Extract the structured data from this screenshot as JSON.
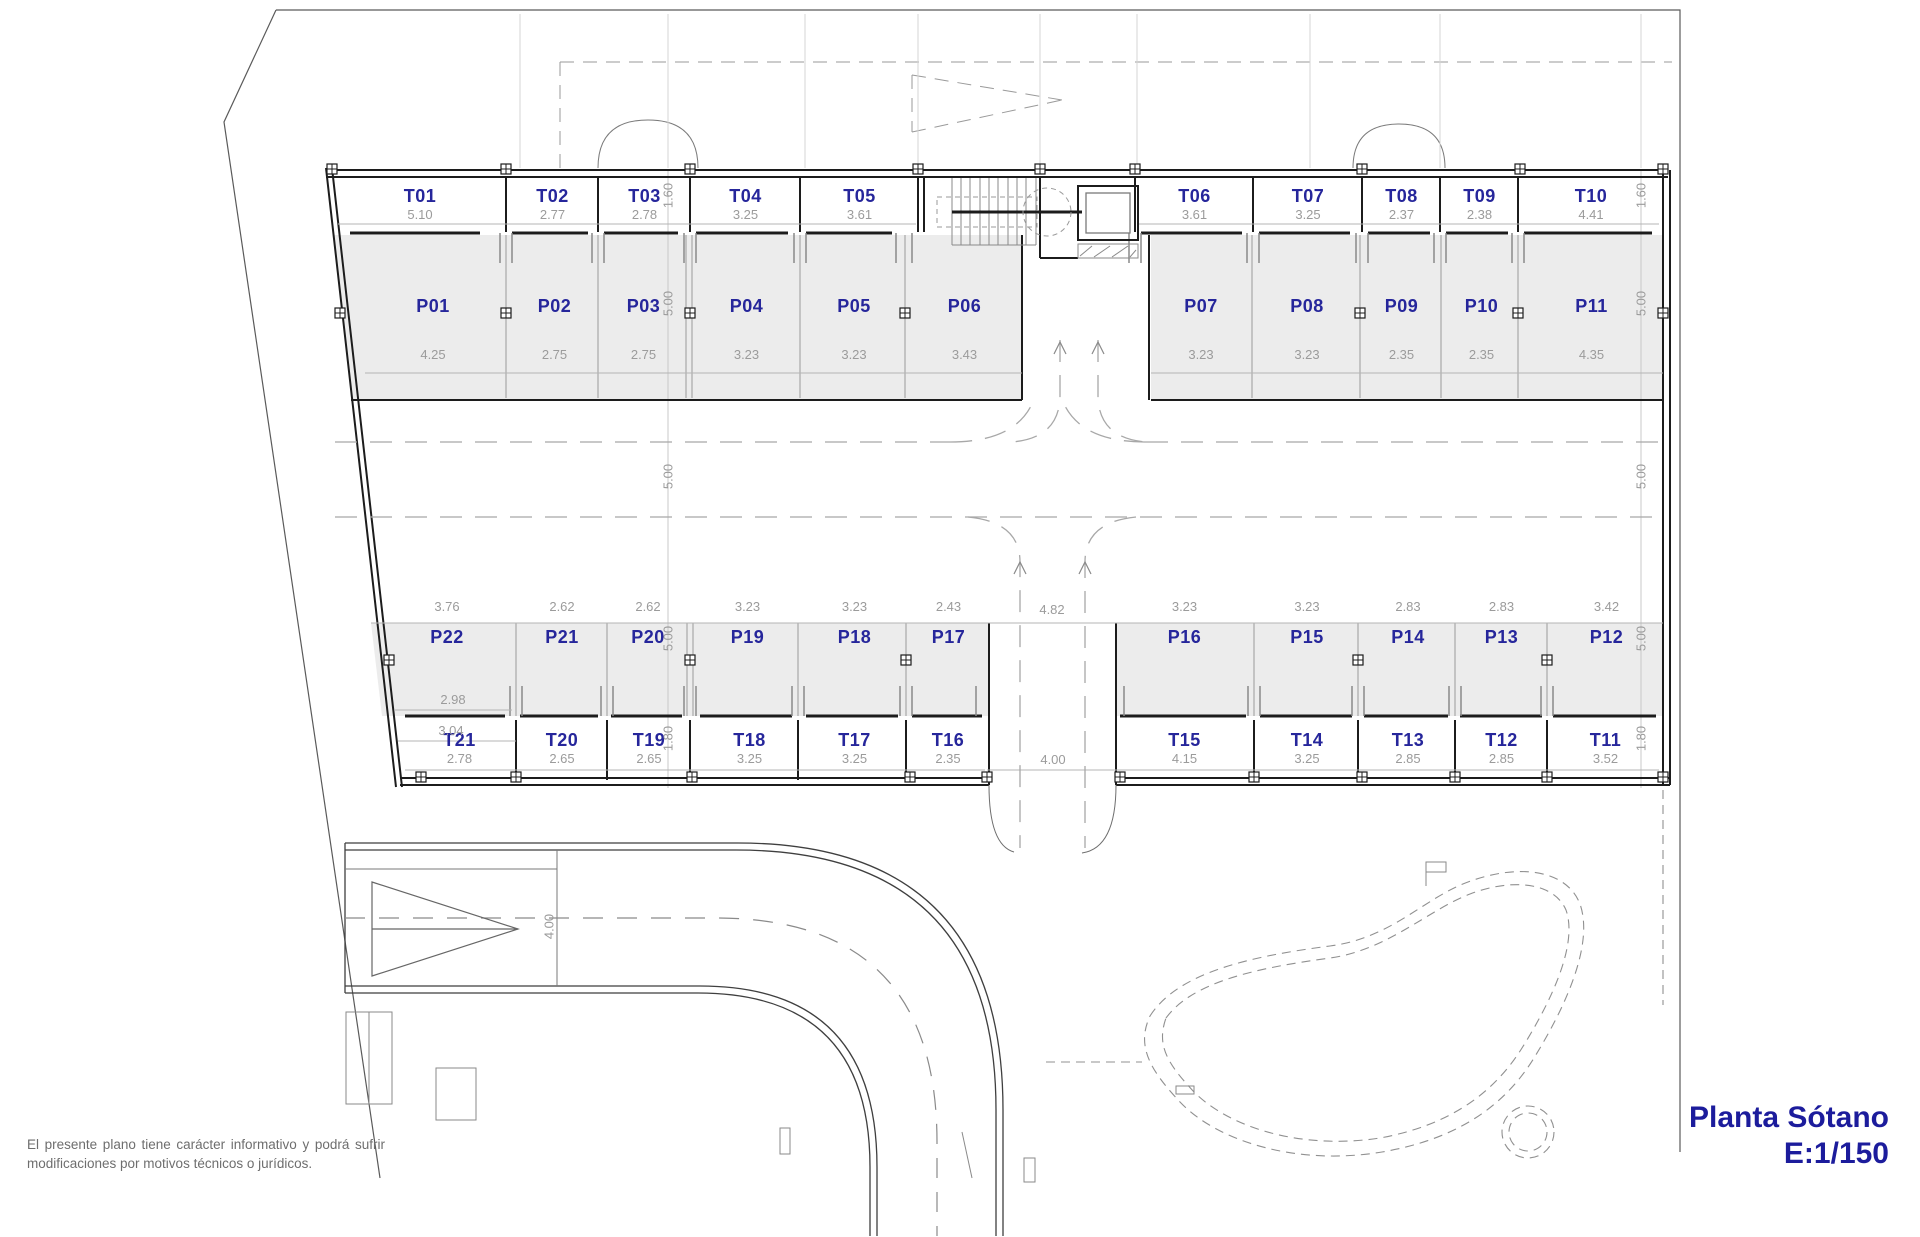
{
  "title": {
    "name": "Planta Sótano",
    "scale": "E:1/150"
  },
  "disclaimer": "El presente plano tiene carácter informativo y podrá sufrir modificaciones por motivos técnicos o jurídicos.",
  "colors": {
    "label": "#26269b",
    "dimension": "#9b9b9b",
    "stall_fill": "#ececec",
    "wall": "#1c1c1c",
    "title": "#1c1c9c"
  },
  "parking_top": [
    {
      "id": "P01",
      "size": "4.25"
    },
    {
      "id": "P02",
      "size": "2.75"
    },
    {
      "id": "P03",
      "size": "2.75"
    },
    {
      "id": "P04",
      "size": "3.23"
    },
    {
      "id": "P05",
      "size": "3.23"
    },
    {
      "id": "P06",
      "size": "3.43"
    },
    {
      "id": "P07",
      "size": "3.23"
    },
    {
      "id": "P08",
      "size": "3.23"
    },
    {
      "id": "P09",
      "size": "2.35"
    },
    {
      "id": "P10",
      "size": "2.35"
    },
    {
      "id": "P11",
      "size": "4.35"
    }
  ],
  "storage_top": [
    {
      "id": "T01",
      "size": "5.10"
    },
    {
      "id": "T02",
      "size": "2.77"
    },
    {
      "id": "T03",
      "size": "2.78"
    },
    {
      "id": "T04",
      "size": "3.25"
    },
    {
      "id": "T05",
      "size": "3.61"
    },
    {
      "id": "T06",
      "size": "3.61"
    },
    {
      "id": "T07",
      "size": "3.25"
    },
    {
      "id": "T08",
      "size": "2.37"
    },
    {
      "id": "T09",
      "size": "2.38"
    },
    {
      "id": "T10",
      "size": "4.41"
    }
  ],
  "parking_bottom": [
    {
      "id": "P22",
      "size": "3.76"
    },
    {
      "id": "P21",
      "size": "2.62"
    },
    {
      "id": "P20",
      "size": "2.62"
    },
    {
      "id": "P19",
      "size": "3.23"
    },
    {
      "id": "P18",
      "size": "3.23"
    },
    {
      "id": "P17",
      "size": "2.43"
    },
    {
      "id": "P16",
      "size": "3.23"
    },
    {
      "id": "P15",
      "size": "3.23"
    },
    {
      "id": "P14",
      "size": "2.83"
    },
    {
      "id": "P13",
      "size": "2.83"
    },
    {
      "id": "P12",
      "size": "3.42"
    }
  ],
  "storage_bottom": [
    {
      "id": "T21",
      "size": "2.78"
    },
    {
      "id": "T20",
      "size": "2.65"
    },
    {
      "id": "T19",
      "size": "2.65"
    },
    {
      "id": "T18",
      "size": "3.25"
    },
    {
      "id": "T17",
      "size": "3.25"
    },
    {
      "id": "T16",
      "size": "2.35"
    },
    {
      "id": "T15",
      "size": "4.15"
    },
    {
      "id": "T14",
      "size": "3.25"
    },
    {
      "id": "T13",
      "size": "2.85"
    },
    {
      "id": "T12",
      "size": "2.85"
    },
    {
      "id": "T11",
      "size": "3.52"
    }
  ],
  "dims": {
    "storage_depth_top": "1.60",
    "parking_depth": "5.00",
    "aisle_width": "5.00",
    "storage_depth_bottom": "1.80",
    "p22_front": "2.98",
    "p22_back": "3.04",
    "center_ramp_width": "4.82",
    "south_exit_width": "4.00",
    "west_ramp_width": "4.00"
  }
}
